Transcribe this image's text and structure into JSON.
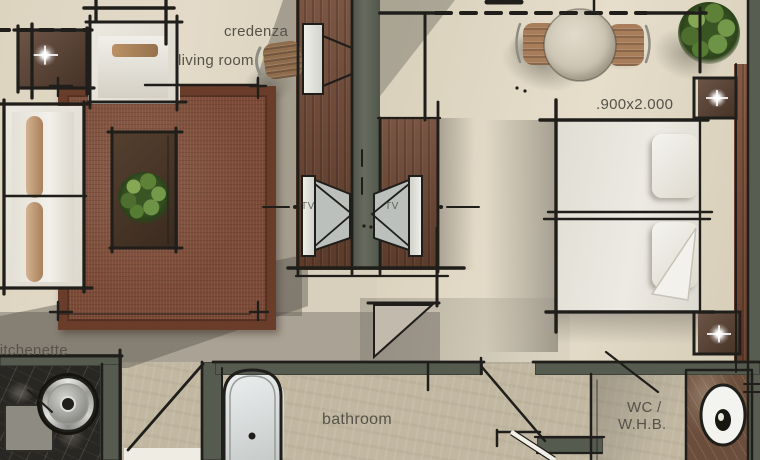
{
  "canvas": {
    "width": 760,
    "height": 460,
    "type": "hotel-suite floor plan rendering"
  },
  "labels": {
    "credenza": "credenza",
    "living_room": "living room",
    "bed_dimensions": ".900x2.000",
    "tv_left": "TV",
    "tv_right": "TV",
    "kitchenette": "kitchenette",
    "bathroom": "bathroom",
    "wc_line1": "WC /",
    "wc_line2": "W.H.B."
  },
  "palette": {
    "floor_living": "#ddd4c0",
    "floor_bedroom": "#e0d7c3",
    "floor_hall": "#aaa295",
    "floor_bath_travertine": "#c2b8a2",
    "rug_brown": "#7b4a36",
    "wood_console": "#6f4733",
    "wall_green_gray": "#565b50",
    "sketch_ink": "#1f1e1a",
    "kitchen_marble": "#292723",
    "wc_marble": "#6b4e3c",
    "fabric_white": "#ece9e1",
    "plant_green": "#5e8138",
    "label_text": "#56524a"
  }
}
